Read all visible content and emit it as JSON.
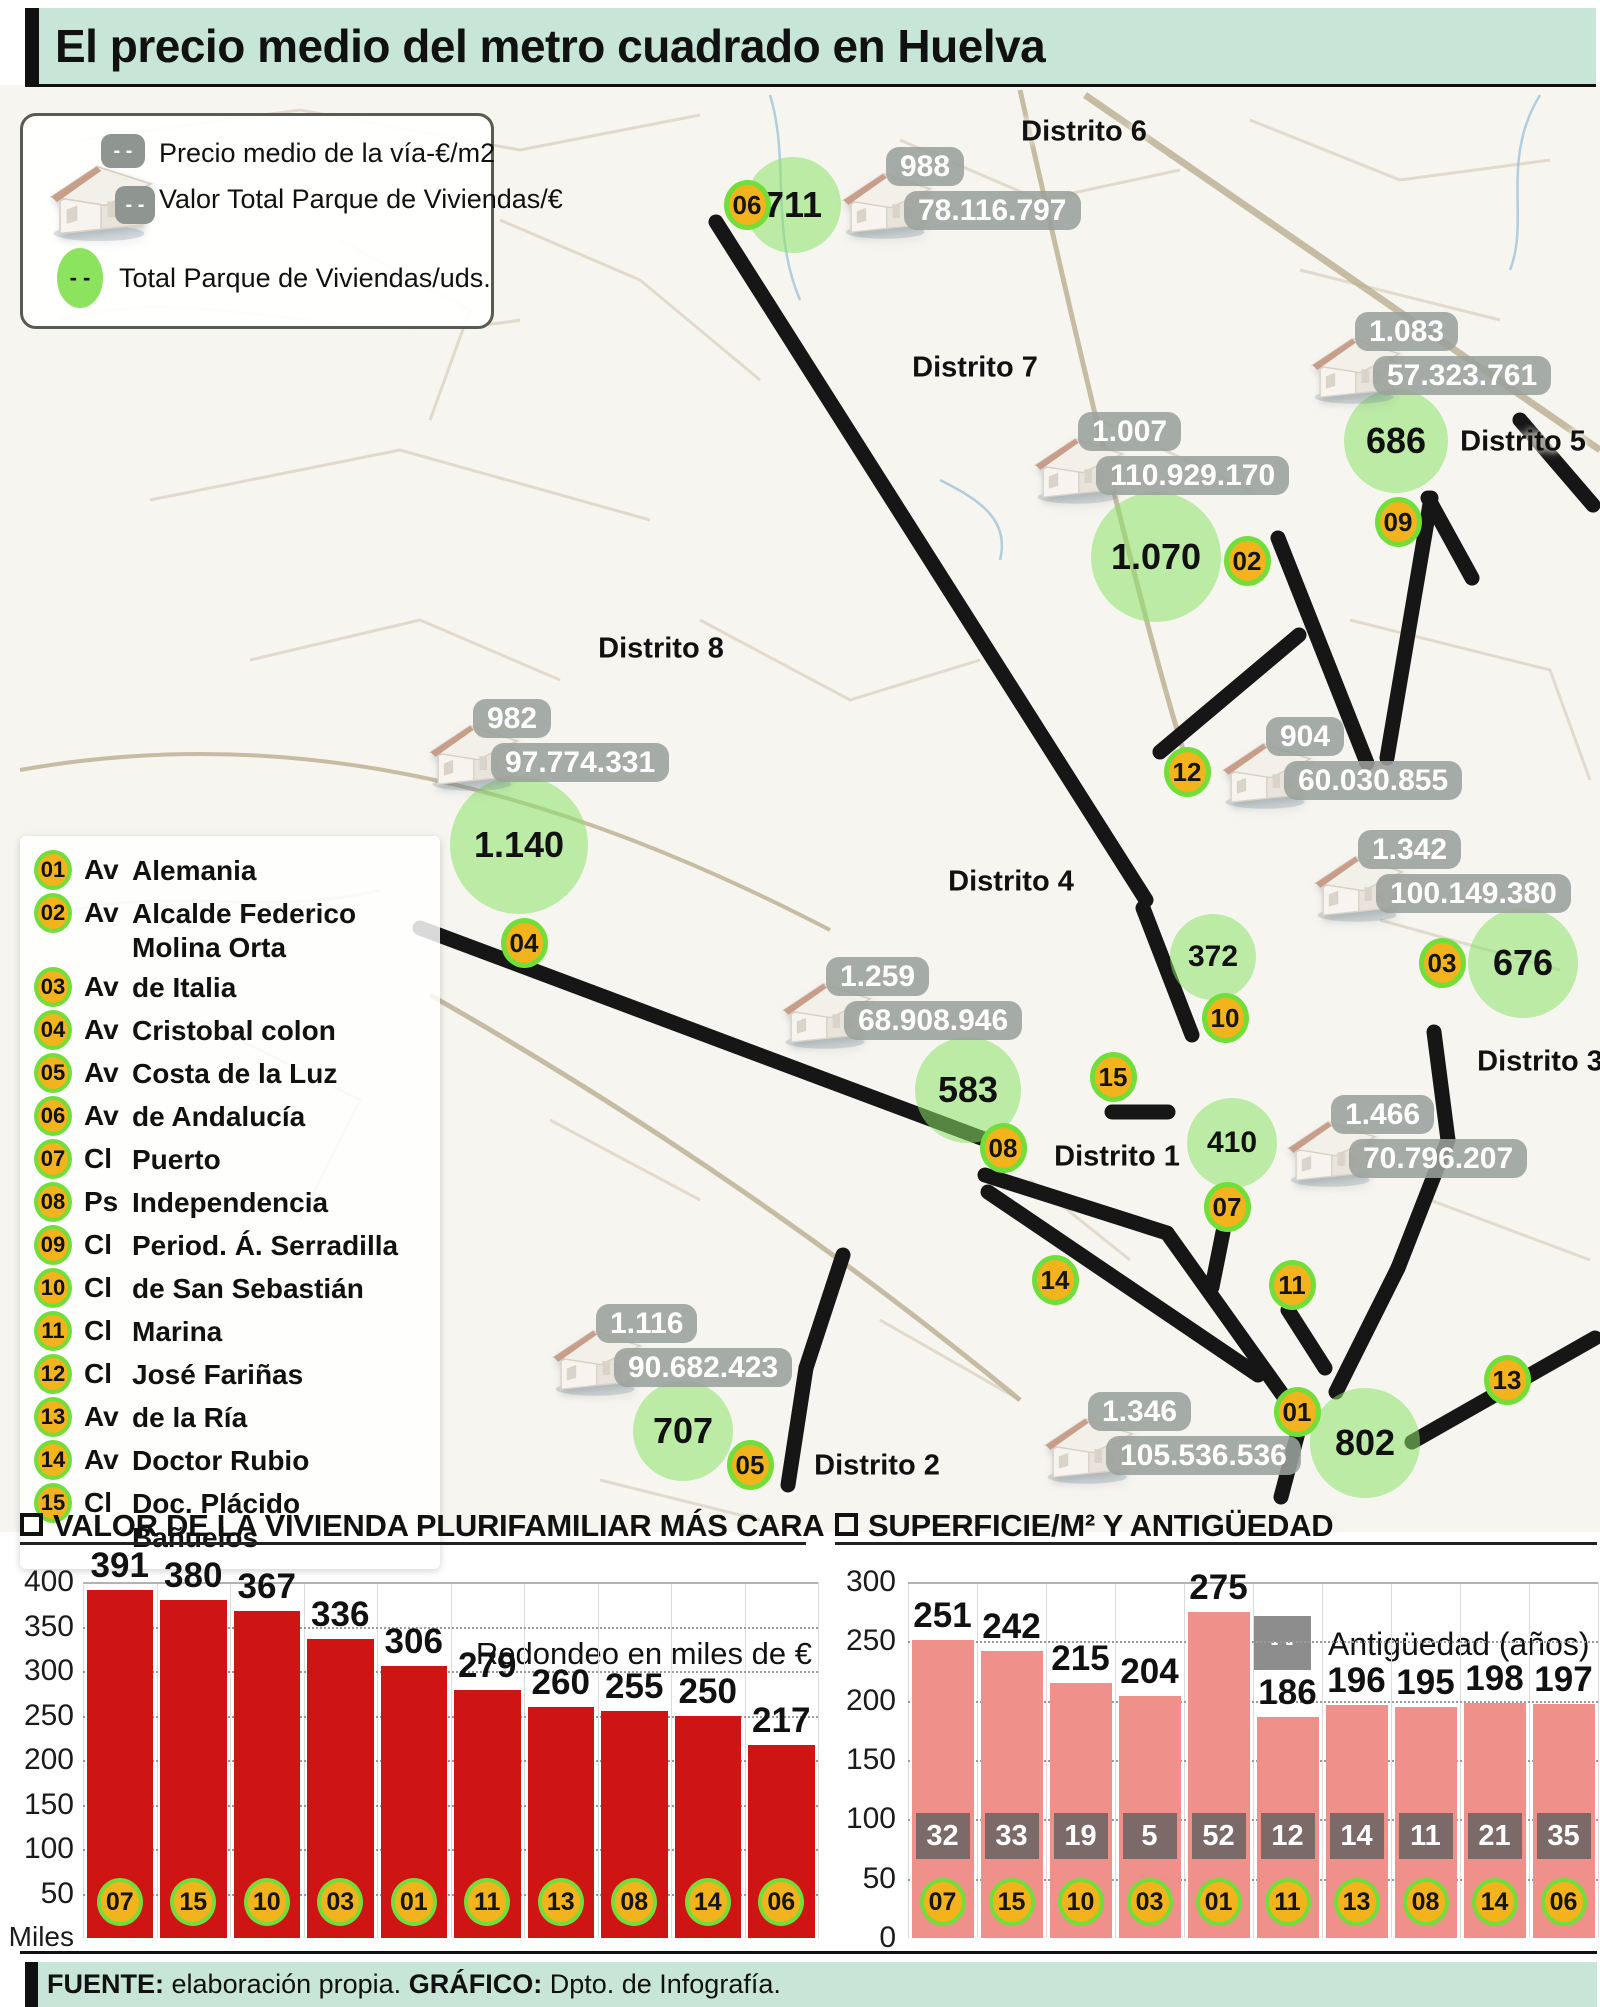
{
  "header": {
    "title": "El precio medio del metro cuadrado en Huelva"
  },
  "map_legend": {
    "dash": "- -",
    "price_label": "Precio medio de la vía-€/m2",
    "value_label": "Valor Total Parque de Viviendas/€",
    "total_label": "Total Parque de Viviendas/uds."
  },
  "street_index": [
    {
      "id": "01",
      "prefix": "Av",
      "name": "Alemania"
    },
    {
      "id": "02",
      "prefix": "Av",
      "name": "Alcalde Federico Molina Orta"
    },
    {
      "id": "03",
      "prefix": "Av",
      "name": "de Italia"
    },
    {
      "id": "04",
      "prefix": "Av",
      "name": "Cristobal colon"
    },
    {
      "id": "05",
      "prefix": "Av",
      "name": "Costa de la Luz"
    },
    {
      "id": "06",
      "prefix": "Av",
      "name": "de Andalucía"
    },
    {
      "id": "07",
      "prefix": "Cl",
      "name": "Puerto"
    },
    {
      "id": "08",
      "prefix": "Ps",
      "name": "Independencia"
    },
    {
      "id": "09",
      "prefix": "Cl",
      "name": "Period. Á. Serradilla"
    },
    {
      "id": "10",
      "prefix": "Cl",
      "name": "de San Sebastián"
    },
    {
      "id": "11",
      "prefix": "Cl",
      "name": "Marina"
    },
    {
      "id": "12",
      "prefix": "Cl",
      "name": "José Fariñas"
    },
    {
      "id": "13",
      "prefix": "Av",
      "name": "de la Ría"
    },
    {
      "id": "14",
      "prefix": "Av",
      "name": "Doctor Rubio"
    },
    {
      "id": "15",
      "prefix": "Cl",
      "name": "Doc. Plácido Bañuelos"
    }
  ],
  "map": {
    "districts": [
      {
        "label": "Distrito 6",
        "x": 1084,
        "y": 132
      },
      {
        "label": "Distrito 7",
        "x": 975,
        "y": 368
      },
      {
        "label": "Distrito 5",
        "x": 1523,
        "y": 442
      },
      {
        "label": "Distrito 8",
        "x": 661,
        "y": 649
      },
      {
        "label": "Distrito 4",
        "x": 1011,
        "y": 882
      },
      {
        "label": "Distrito 3",
        "x": 1540,
        "y": 1062
      },
      {
        "label": "Distrito 1",
        "x": 1117,
        "y": 1157
      },
      {
        "label": "Distrito 2",
        "x": 877,
        "y": 1466
      }
    ],
    "markers": [
      {
        "id": "01",
        "x": 1297,
        "y": 1412
      },
      {
        "id": "02",
        "x": 1247,
        "y": 561
      },
      {
        "id": "03",
        "x": 1442,
        "y": 963
      },
      {
        "id": "04",
        "x": 524,
        "y": 943
      },
      {
        "id": "05",
        "x": 750,
        "y": 1465
      },
      {
        "id": "06",
        "x": 747,
        "y": 205
      },
      {
        "id": "07",
        "x": 1227,
        "y": 1207
      },
      {
        "id": "08",
        "x": 1003,
        "y": 1148
      },
      {
        "id": "09",
        "x": 1398,
        "y": 522
      },
      {
        "id": "10",
        "x": 1225,
        "y": 1018
      },
      {
        "id": "11",
        "x": 1292,
        "y": 1285
      },
      {
        "id": "12",
        "x": 1187,
        "y": 772
      },
      {
        "id": "13",
        "x": 1507,
        "y": 1380
      },
      {
        "id": "14",
        "x": 1055,
        "y": 1280
      },
      {
        "id": "15",
        "x": 1113,
        "y": 1077
      }
    ],
    "housing_totals": [
      {
        "value": "711",
        "x": 793,
        "y": 205,
        "r": 48
      },
      {
        "value": "686",
        "x": 1396,
        "y": 441,
        "r": 52
      },
      {
        "value": "1.070",
        "x": 1156,
        "y": 557,
        "r": 65
      },
      {
        "value": "1.140",
        "x": 519,
        "y": 845,
        "r": 69
      },
      {
        "value": "372",
        "x": 1213,
        "y": 957,
        "r": 43
      },
      {
        "value": "676",
        "x": 1523,
        "y": 963,
        "r": 55
      },
      {
        "value": "583",
        "x": 968,
        "y": 1090,
        "r": 53
      },
      {
        "value": "410",
        "x": 1232,
        "y": 1143,
        "r": 45
      },
      {
        "value": "707",
        "x": 683,
        "y": 1431,
        "r": 50
      },
      {
        "value": "802",
        "x": 1365,
        "y": 1443,
        "r": 55
      }
    ],
    "houses": [
      {
        "price": "988",
        "total": "78.116.797",
        "x": 838,
        "y": 165
      },
      {
        "price": "1.083",
        "total": "57.323.761",
        "x": 1307,
        "y": 330
      },
      {
        "price": "1.007",
        "total": "110.929.170",
        "x": 1030,
        "y": 430
      },
      {
        "price": "982",
        "total": "97.774.331",
        "x": 425,
        "y": 717
      },
      {
        "price": "904",
        "total": "60.030.855",
        "x": 1218,
        "y": 735
      },
      {
        "price": "1.342",
        "total": "100.149.380",
        "x": 1310,
        "y": 848
      },
      {
        "price": "1.259",
        "total": "68.908.946",
        "x": 778,
        "y": 975
      },
      {
        "price": "1.466",
        "total": "70.796.207",
        "x": 1283,
        "y": 1113
      },
      {
        "price": "1.116",
        "total": "90.682.423",
        "x": 548,
        "y": 1322
      },
      {
        "price": "1.346",
        "total": "105.536.536",
        "x": 1040,
        "y": 1410
      }
    ],
    "lines": [
      [
        716,
        222,
        1146,
        900
      ],
      [
        1143,
        908,
        1192,
        1035
      ],
      [
        1278,
        538,
        1367,
        763
      ],
      [
        1299,
        635,
        1160,
        752
      ],
      [
        1431,
        498,
        1387,
        758
      ],
      [
        1428,
        498,
        1472,
        578
      ],
      [
        1520,
        420,
        1593,
        505
      ],
      [
        420,
        928,
        1000,
        1145
      ],
      [
        1112,
        1112,
        1168,
        1112
      ],
      [
        1223,
        1232,
        1212,
        1287
      ],
      [
        1288,
        1310,
        1325,
        1368
      ],
      [
        985,
        1175,
        1167,
        1233
      ],
      [
        988,
        1192,
        1258,
        1375
      ],
      [
        1167,
        1233,
        1302,
        1422
      ],
      [
        1434,
        1032,
        1448,
        1140
      ],
      [
        1448,
        1140,
        1398,
        1268
      ],
      [
        1398,
        1268,
        1336,
        1392
      ],
      [
        1595,
        1338,
        1412,
        1442
      ],
      [
        1300,
        1425,
        1281,
        1497
      ],
      [
        843,
        1255,
        806,
        1368
      ],
      [
        806,
        1368,
        788,
        1485
      ]
    ]
  },
  "colors": {
    "header_bg": "#c7e6d8",
    "marker_fill": "#f2b31d",
    "marker_ring": "#72de3a",
    "total_circle": "#8de267",
    "badge_bg": "#9aa09b",
    "bar_red": "#cf1414",
    "bar_pink": "#ef908a",
    "age_badge": "#7b6a68",
    "line_black": "#161616"
  },
  "chart_data": [
    {
      "type": "bar",
      "title": "VALOR DE LA VIVIENDA PLURIFAMILIAR MÁS CARA",
      "note": "Redondeo en miles de €",
      "unit_label": "Miles",
      "categories": [
        "07",
        "15",
        "10",
        "03",
        "01",
        "11",
        "13",
        "08",
        "14",
        "06"
      ],
      "values": [
        391,
        380,
        367,
        336,
        306,
        279,
        260,
        255,
        250,
        217
      ],
      "ylim": [
        0,
        400
      ],
      "yticks": [
        400,
        350,
        300,
        250,
        200,
        150,
        100,
        50
      ],
      "bar_color": "#cf1414",
      "grid": "dotted",
      "legend_position": "none"
    },
    {
      "type": "bar",
      "title": "SUPERFICIE/M² Y ANTIGÜEDAD",
      "legend": "Antigüedad (años)",
      "categories": [
        "07",
        "15",
        "10",
        "03",
        "01",
        "11",
        "13",
        "08",
        "14",
        "06"
      ],
      "series": [
        {
          "name": "Superficie/m2",
          "values": [
            251,
            242,
            215,
            204,
            275,
            186,
            196,
            195,
            198,
            197
          ]
        },
        {
          "name": "Antigüedad (años)",
          "values": [
            32,
            33,
            19,
            5,
            52,
            12,
            14,
            11,
            21,
            35
          ]
        }
      ],
      "ylim": [
        0,
        300
      ],
      "yticks": [
        300,
        250,
        200,
        150,
        100,
        50,
        0
      ],
      "bar_color": "#ef908a",
      "badge_color": "#7b6a68",
      "grid": "dotted",
      "legend_position": "top-right"
    }
  ],
  "footer": {
    "source_label": "FUENTE:",
    "source": "elaboración propia.",
    "graphic_label": "GRÁFICO:",
    "graphic": "Dpto. de Infografía."
  }
}
